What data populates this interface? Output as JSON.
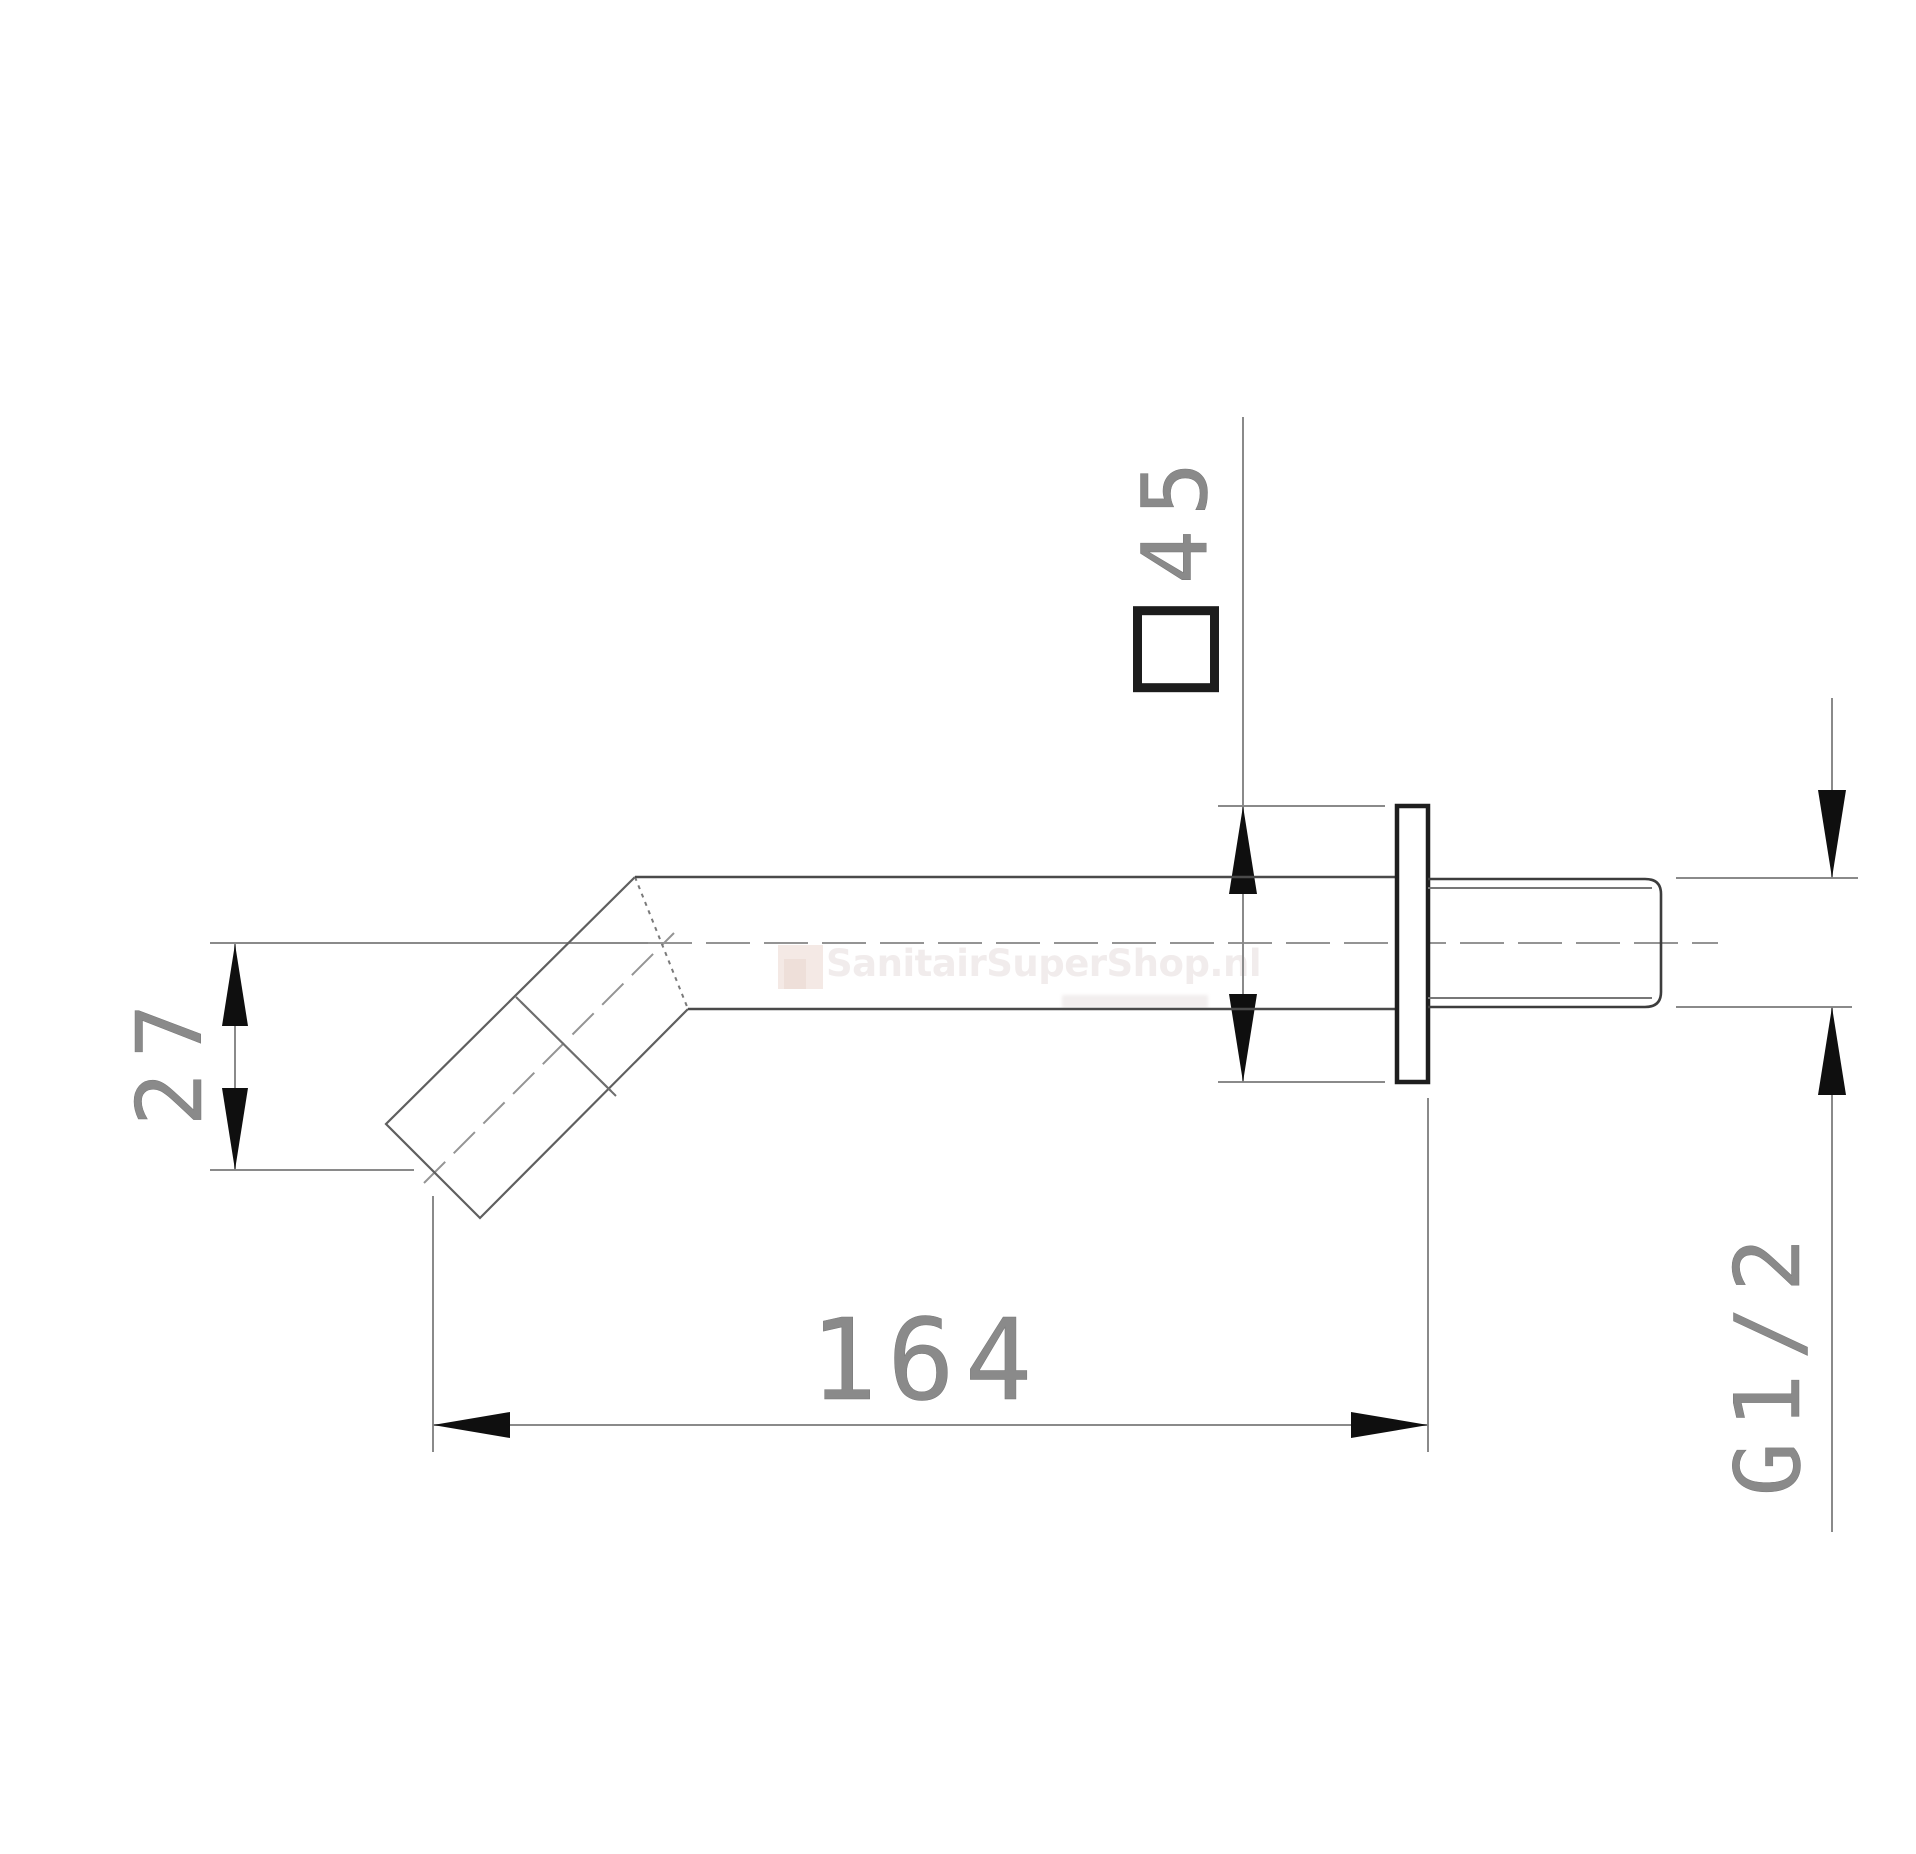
{
  "page": {
    "type": "technical-drawing",
    "background": "#ffffff"
  },
  "watermark": {
    "text": "SanitairSuperShop.nl"
  },
  "dimensions": {
    "length": "164",
    "spout_drop": "27",
    "flange_size": "45",
    "flange_symbol": "□",
    "thread_size": "G1/2"
  },
  "colors": {
    "part_outline": "#5f5f5f",
    "tube_outline": "#4a4a4a",
    "flange_outline": "#1e1e1e",
    "dimension_line": "#8a8a8a",
    "arrow": "#0f0f0f",
    "cad_text": "#8a8a8a",
    "watermark_text": "#f1ecec"
  }
}
